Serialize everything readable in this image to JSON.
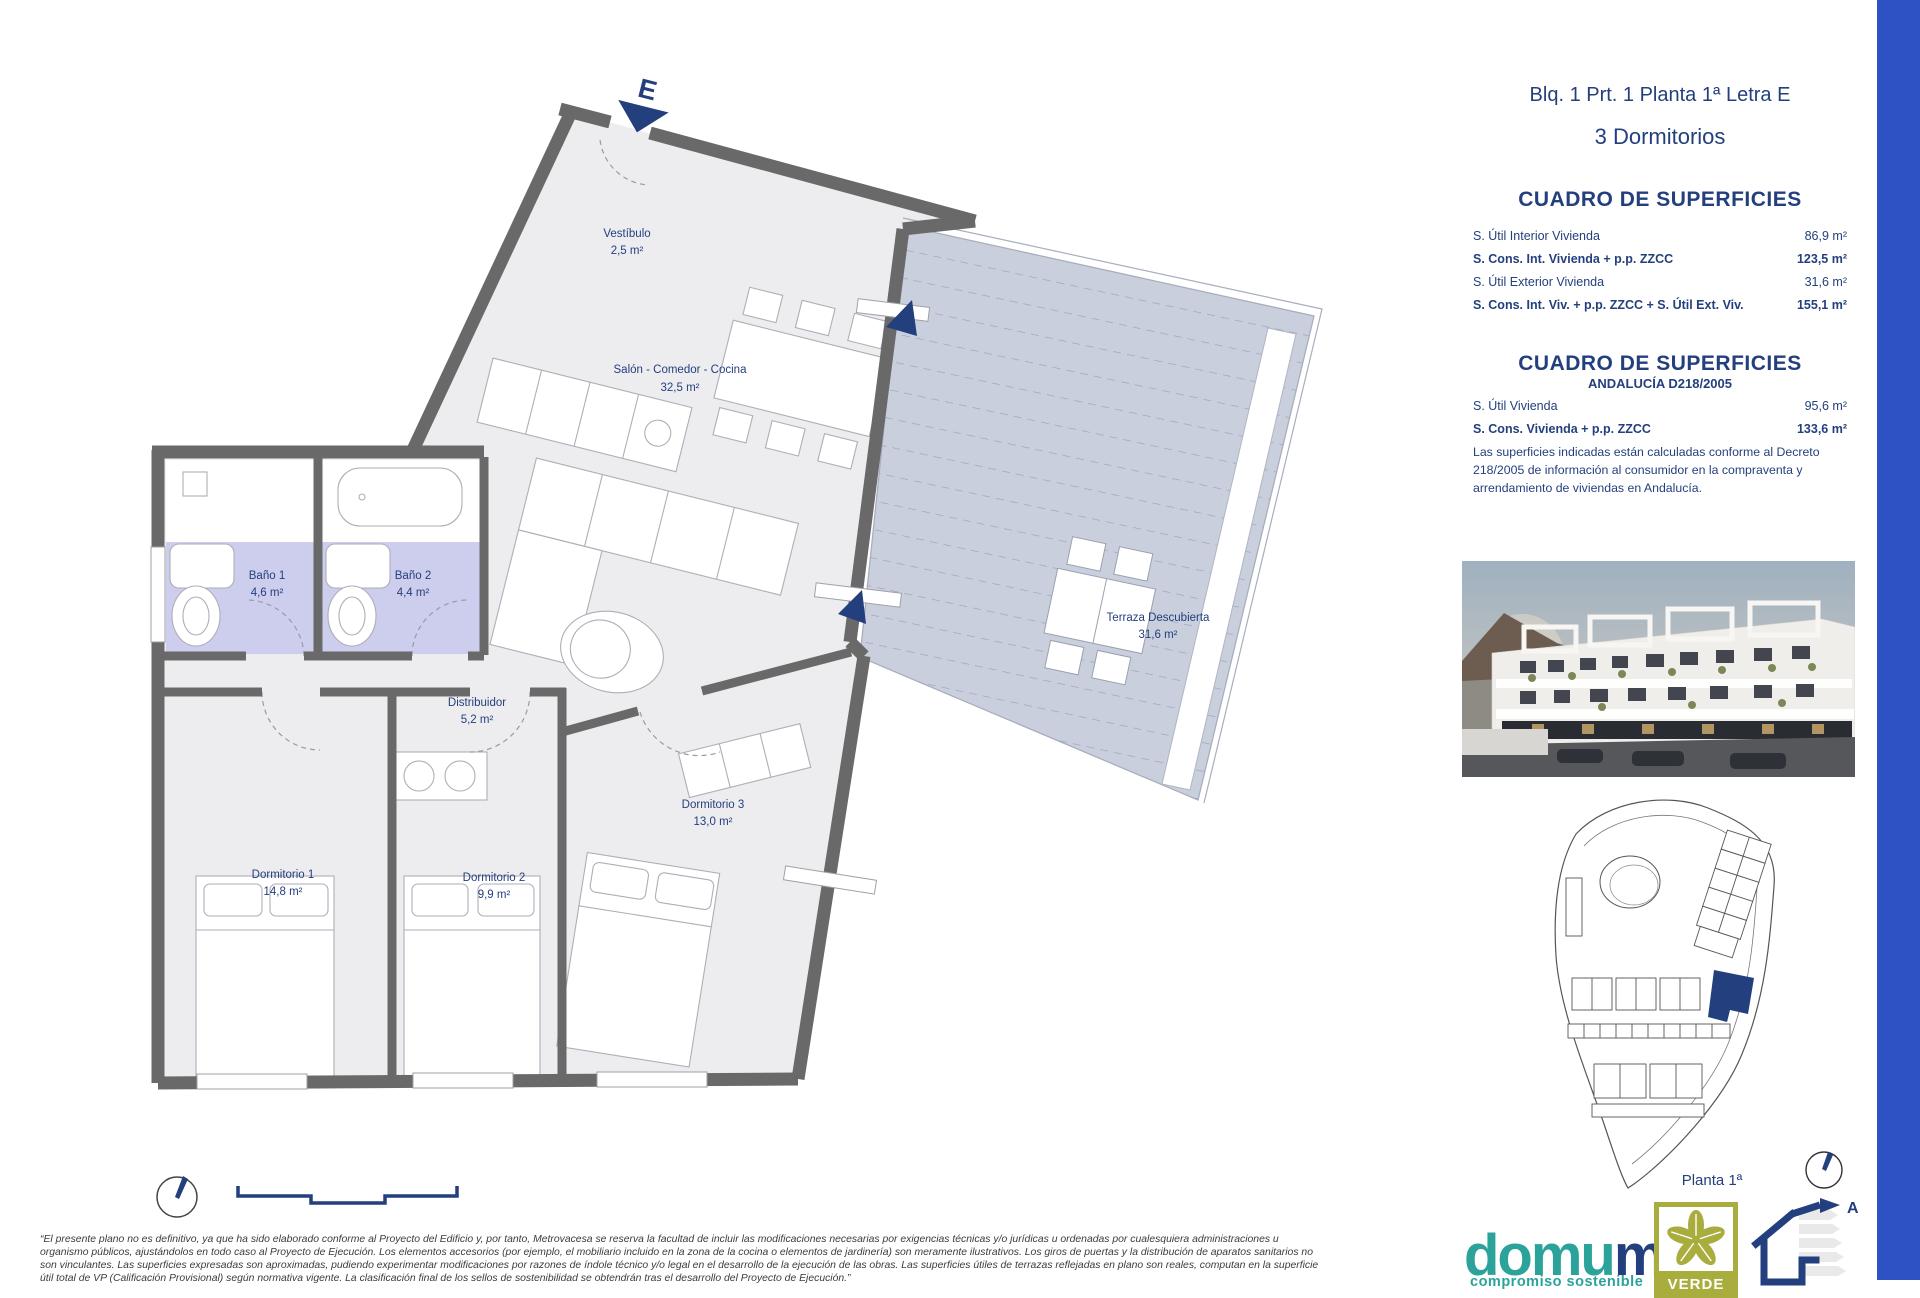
{
  "header": {
    "title_line1": "Blq. 1 Prt. 1 Planta 1ª Letra E",
    "title_line2": "3 Dormitorios"
  },
  "tables": {
    "table1": {
      "title": "CUADRO DE SUPERFICIES",
      "rows": [
        {
          "label": "S. Útil Interior Vivienda",
          "value": "86,9 m²"
        },
        {
          "label": "S. Cons. Int. Vivienda + p.p. ZZCC",
          "value": "123,5 m²"
        },
        {
          "label": "S. Útil Exterior Vivienda",
          "value": "31,6 m²"
        },
        {
          "label": "S. Cons. Int. Viv. + p.p. ZZCC + S. Útil Ext. Viv.",
          "value": "155,1 m²"
        }
      ]
    },
    "table2": {
      "title": "CUADRO DE SUPERFICIES",
      "subtitle": "ANDALUCÍA D218/2005",
      "rows": [
        {
          "label": "S. Útil Vivienda",
          "value": "95,6 m²"
        },
        {
          "label": "S. Cons. Vivienda + p.p. ZZCC",
          "value": "133,6 m²"
        }
      ],
      "note": "Las superficies indicadas están calculadas conforme al Decreto 218/2005 de información al consumidor en la compraventa y arrendamiento de viviendas en Andalucía."
    }
  },
  "plan": {
    "entrance_letter": "E",
    "rooms": [
      {
        "name": "Vestíbulo",
        "area": "2,5 m²"
      },
      {
        "name": "Salón - Comedor - Cocina",
        "area": "32,5 m²"
      },
      {
        "name": "Baño 1",
        "area": "4,6 m²"
      },
      {
        "name": "Baño 2",
        "area": "4,4 m²"
      },
      {
        "name": "Distribuidor",
        "area": "5,2 m²"
      },
      {
        "name": "Dormitorio 1",
        "area": "14,8 m²"
      },
      {
        "name": "Dormitorio 2",
        "area": "9,9 m²"
      },
      {
        "name": "Dormitorio 3",
        "area": "13,0 m²"
      },
      {
        "name": "Terraza Descubierta",
        "area": "31,6 m²"
      }
    ]
  },
  "sidebar_footer": {
    "floor_label": "Planta 1ª",
    "brand_part1": "domu",
    "brand_part2": "m",
    "brand_tagline": "compromiso sostenible",
    "cert_label": "VERDE",
    "energy_label": "A"
  },
  "footer": {
    "disclaimer_lines": [
      "“El presente plano no es definitivo, ya que ha sido elaborado conforme al Proyecto del Edificio y, por tanto, Metrovacesa se reserva la facultad de incluir las modificaciones necesarias por exigencias técnicas y/o jurídicas u ordenadas por cualesquiera administraciones u",
      "organismo públicos, ajustándolos en todo caso al Proyecto de Ejecución. Los elementos accesorios (por ejemplo, el mobiliario incluido en la zona de la cocina o elementos de jardinería) son meramente ilustrativos. Los giros de puertas y la distribución de aparatos sanitarios no",
      "son vinculantes. Las superficies expresadas son aproximadas, pudiendo experimentar modificaciones por razones de índole técnico y/o legal en el desarrollo de la ejecución de las obras. Las superficies útiles de terrazas reflejadas en plano son reales, computan en la superficie",
      "útil total de VP (Calificación Provisional) según normativa vigente. La clasificación final de los sellos de sostenibilidad se obtendrán tras el desarrollo del Proyecto de Ejecución.”"
    ]
  },
  "colors": {
    "navy": "#233f7d",
    "teal": "#2ba39b",
    "olive": "#a9ad3e",
    "side_bar_blue": "#2e52c4",
    "wall_grey": "#696969",
    "floor_grey": "#ededf0",
    "terrace_blue_grey": "#c9cfdd",
    "bathroom_lavender": "#cdcdee"
  }
}
